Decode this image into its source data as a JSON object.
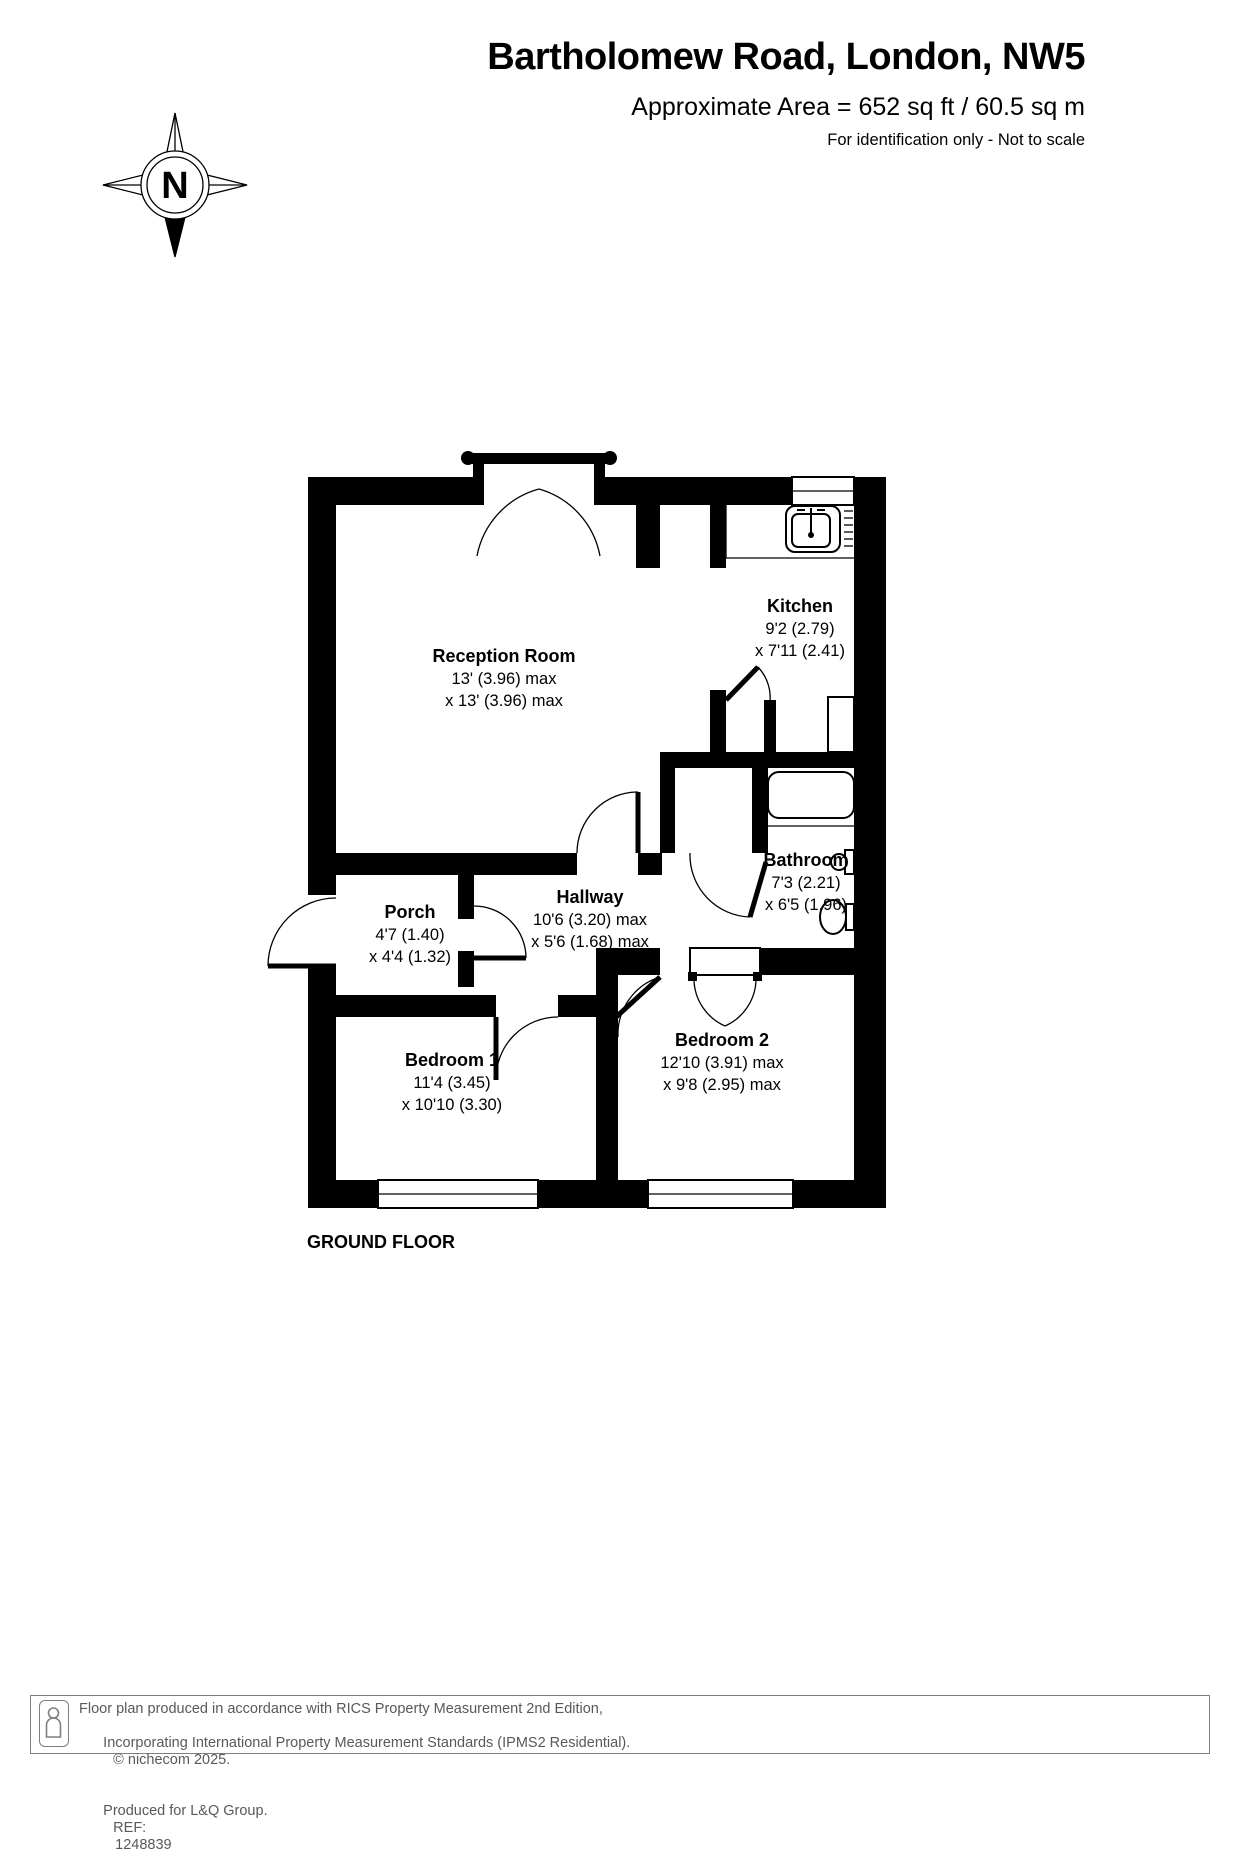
{
  "header": {
    "title": "Bartholomew Road, London, NW5",
    "area": "Approximate Area = 652 sq ft / 60.5 sq m",
    "note": "For identification only - Not to scale"
  },
  "compass": {
    "north_label": "N"
  },
  "floor_label": "GROUND FLOOR",
  "rooms": {
    "reception": {
      "name": "Reception Room",
      "dim1": "13' (3.96) max",
      "dim2": "x 13' (3.96) max"
    },
    "kitchen": {
      "name": "Kitchen",
      "dim1": "9'2 (2.79)",
      "dim2": "x 7'11 (2.41)"
    },
    "bathroom": {
      "name": "Bathroom",
      "dim1": "7'3 (2.21)",
      "dim2": "x 6'5 (1.96)"
    },
    "hallway": {
      "name": "Hallway",
      "dim1": "10'6 (3.20) max",
      "dim2": "x 5'6 (1.68) max"
    },
    "porch": {
      "name": "Porch",
      "dim1": "4'7 (1.40)",
      "dim2": "x 4'4 (1.32)"
    },
    "bedroom1": {
      "name": "Bedroom 1",
      "dim1": "11'4 (3.45)",
      "dim2": "x 10'10 (3.30)"
    },
    "bedroom2": {
      "name": "Bedroom 2",
      "dim1": "12'10 (3.91) max",
      "dim2": "x 9'8 (2.95) max"
    }
  },
  "footer": {
    "line1": "Floor plan produced in accordance with RICS Property Measurement 2nd Edition,",
    "line2": "Incorporating International Property Measurement Standards (IPMS2 Residential).",
    "copyright": "© nichecom 2025.",
    "line3": "Produced for L&Q Group.",
    "ref_label": "REF:",
    "ref_value": "1248839"
  },
  "colors": {
    "wall": "#000000",
    "text": "#000000",
    "footer_text": "#58595b",
    "footer_border": "#7f7f7f",
    "background": "#ffffff"
  }
}
